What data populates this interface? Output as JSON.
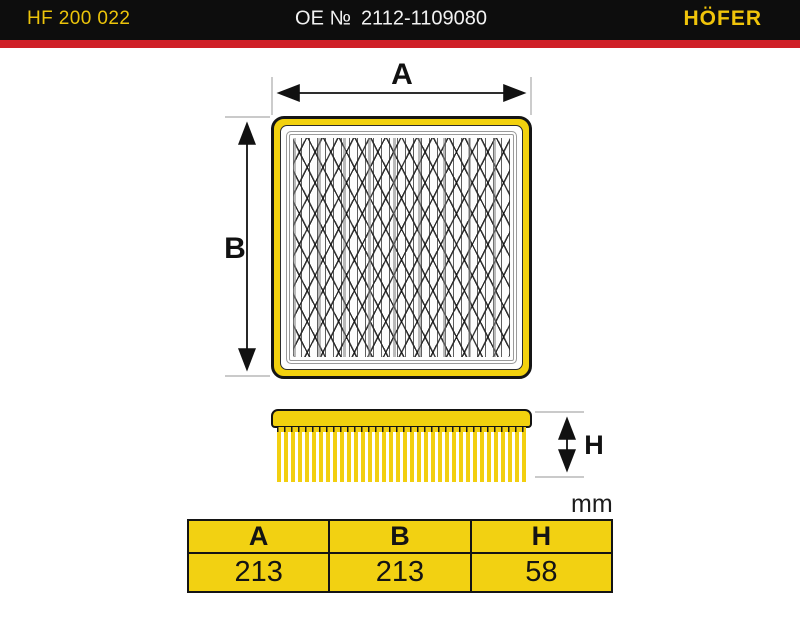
{
  "header": {
    "part_code": "HF 200 022",
    "oe_label": "OE №",
    "oe_number": "2112-1109080",
    "brand": "HÖFER"
  },
  "diagram": {
    "dim_a_label": "A",
    "dim_b_label": "B",
    "dim_h_label": "H",
    "units_label": "mm"
  },
  "dimensions_table": {
    "columns": [
      "A",
      "B",
      "H"
    ],
    "values": [
      "213",
      "213",
      "58"
    ]
  },
  "colors": {
    "brand_yellow": "#f2d10e",
    "header_black": "#0d0d0d",
    "stripe_red": "#cf2027"
  }
}
